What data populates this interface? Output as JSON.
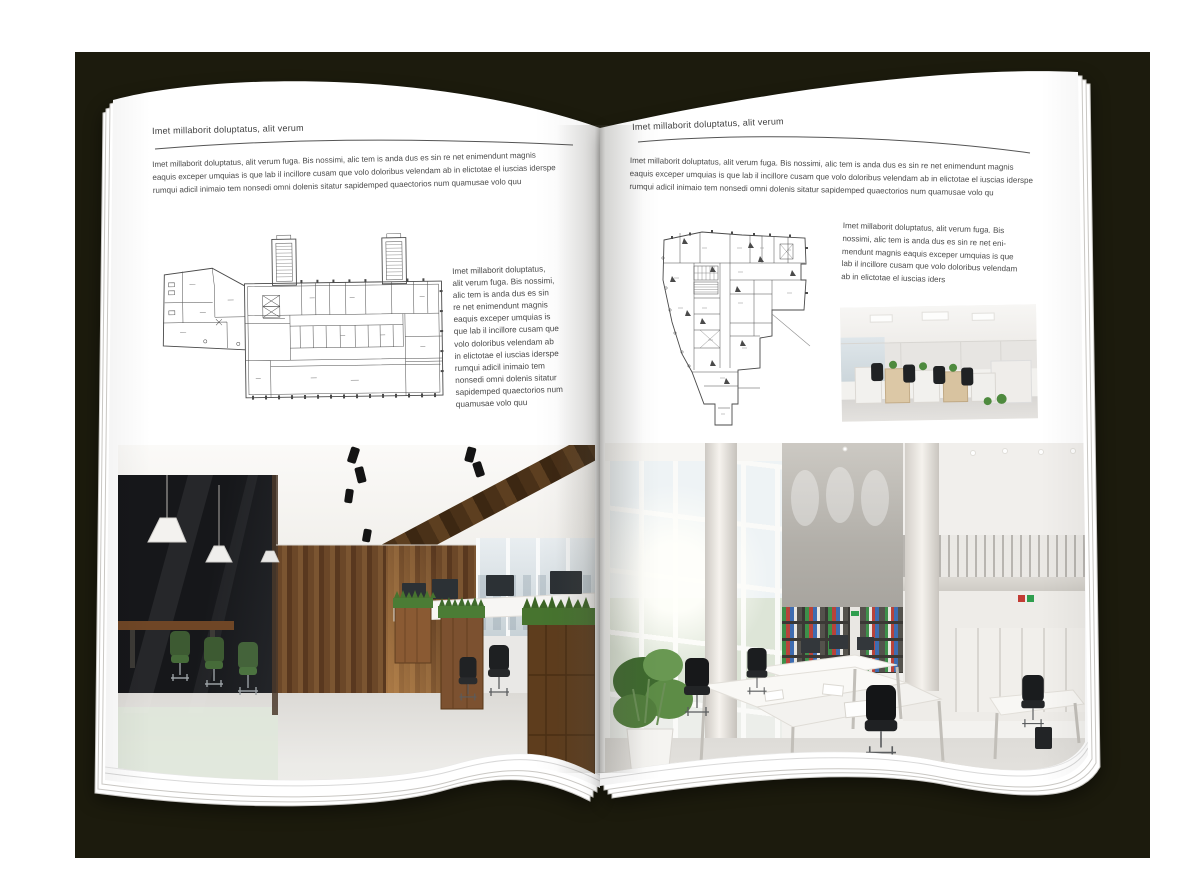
{
  "colors": {
    "backdrop": "#1c1b0d",
    "page": "#ffffff",
    "heading_text": "#3e3e3e",
    "body_text": "#4a4a4a",
    "rule": "#555555",
    "plan_line": "#4a4a4a",
    "wood_accent": "#6b4728",
    "grass_accent": "#4b7c35"
  },
  "left_page": {
    "header": "Imet millaborit doluptatus, alit verum",
    "intro_lines": [
      "Imet millaborit doluptatus, alit verum fuga. Bis nossimi, alic tem is anda dus es sin re net enimendunt magnis",
      "eaquis exceper umquias is que lab il incillore cusam que volo doloribus velendam ab in elictotae el iuscias iderspe",
      "rumqui adicil inimaio tem nonsedi omni dolenis sitatur sapidemped quaectorios num quamusae volo quu"
    ],
    "caption_lines": [
      "Imet millaborit doluptatus,",
      "alit verum fuga. Bis nossimi,",
      "alic tem is anda dus es sin",
      "re net enimendunt magnis",
      "eaquis exceper umquias is",
      "que lab il incillore cusam que",
      "volo doloribus velendam ab",
      "in elictotae el iuscias iderspe",
      "rumqui adicil inimaio tem",
      "nonsedi omni dolenis sitatur",
      "sapidemped quaectorios num",
      "quamusae volo quu"
    ],
    "floor_plan_label": "wide-office-building-floor-plan",
    "photo_label": "loft-style-open-space-office-photo"
  },
  "right_page": {
    "header": "Imet millaborit doluptatus, alit verum",
    "intro_lines": [
      "Imet millaborit doluptatus, alit verum fuga. Bis nossimi, alic tem is anda dus es sin re net enimendunt magnis",
      "eaquis exceper umquias is que lab il incillore cusam que volo doloribus velendam ab in elictotae el iuscias iderspe",
      "rumqui adicil inimaio tem nonsedi omni dolenis sitatur sapidemped quaectorios num quamusae volo qu"
    ],
    "caption_lines": [
      "Imet millaborit doluptatus, alit verum fuga. Bis",
      "nossimi, alic tem is anda dus es sin re net eni-",
      "mendunt magnis eaquis exceper umquias is que",
      "lab il incillore cusam que volo doloribus velendam",
      "ab in elictotae el iuscias iders"
    ],
    "floor_plan_label": "irregular-tower-floor-plan",
    "small_photo_label": "workstation-row-office-photo",
    "photo_label": "double-height-white-office-photo"
  }
}
